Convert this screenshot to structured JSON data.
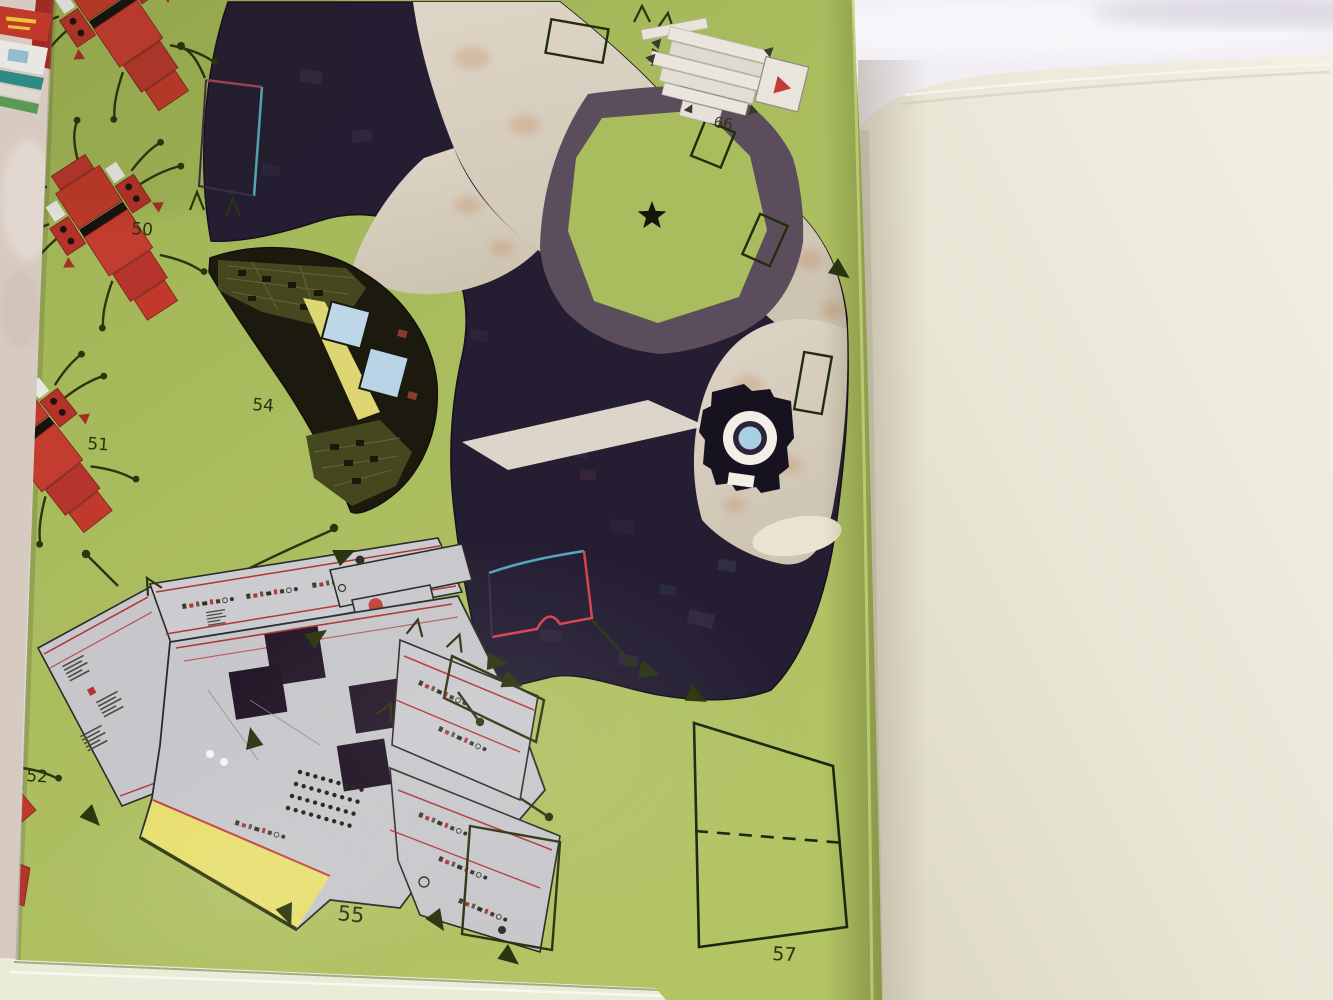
{
  "parts": {
    "chair_50": {
      "label": "50"
    },
    "chair_51": {
      "label": "51"
    },
    "chair_52": {
      "label": "52"
    },
    "console_54": {
      "label": "54"
    },
    "control_panel_55": {
      "label": "55"
    },
    "backdrop_57": {
      "label": "57"
    },
    "bracket_66": {
      "label": "66"
    }
  },
  "colors": {
    "page_green": "#a8bb5c",
    "page_cream": "#ece8da",
    "fabric_background": "#e7e2ec",
    "carpet": "#d7cbc1",
    "floor_dark_navy": "#251e33",
    "path_tan": "#d8cec0",
    "band_purple": "#5b4d5b",
    "octagon_green": "#a9bc5e",
    "panel_gray": "#c7c7cb",
    "accent_yellow": "#e3da6e",
    "chair_red": "#c0392b",
    "screen_blue": "#bdd7e8",
    "tab_olive": "#2b350f",
    "trim_red": "#c03c3c",
    "trim_teal": "#4fa8c2",
    "label_ink": "#2a3110"
  }
}
